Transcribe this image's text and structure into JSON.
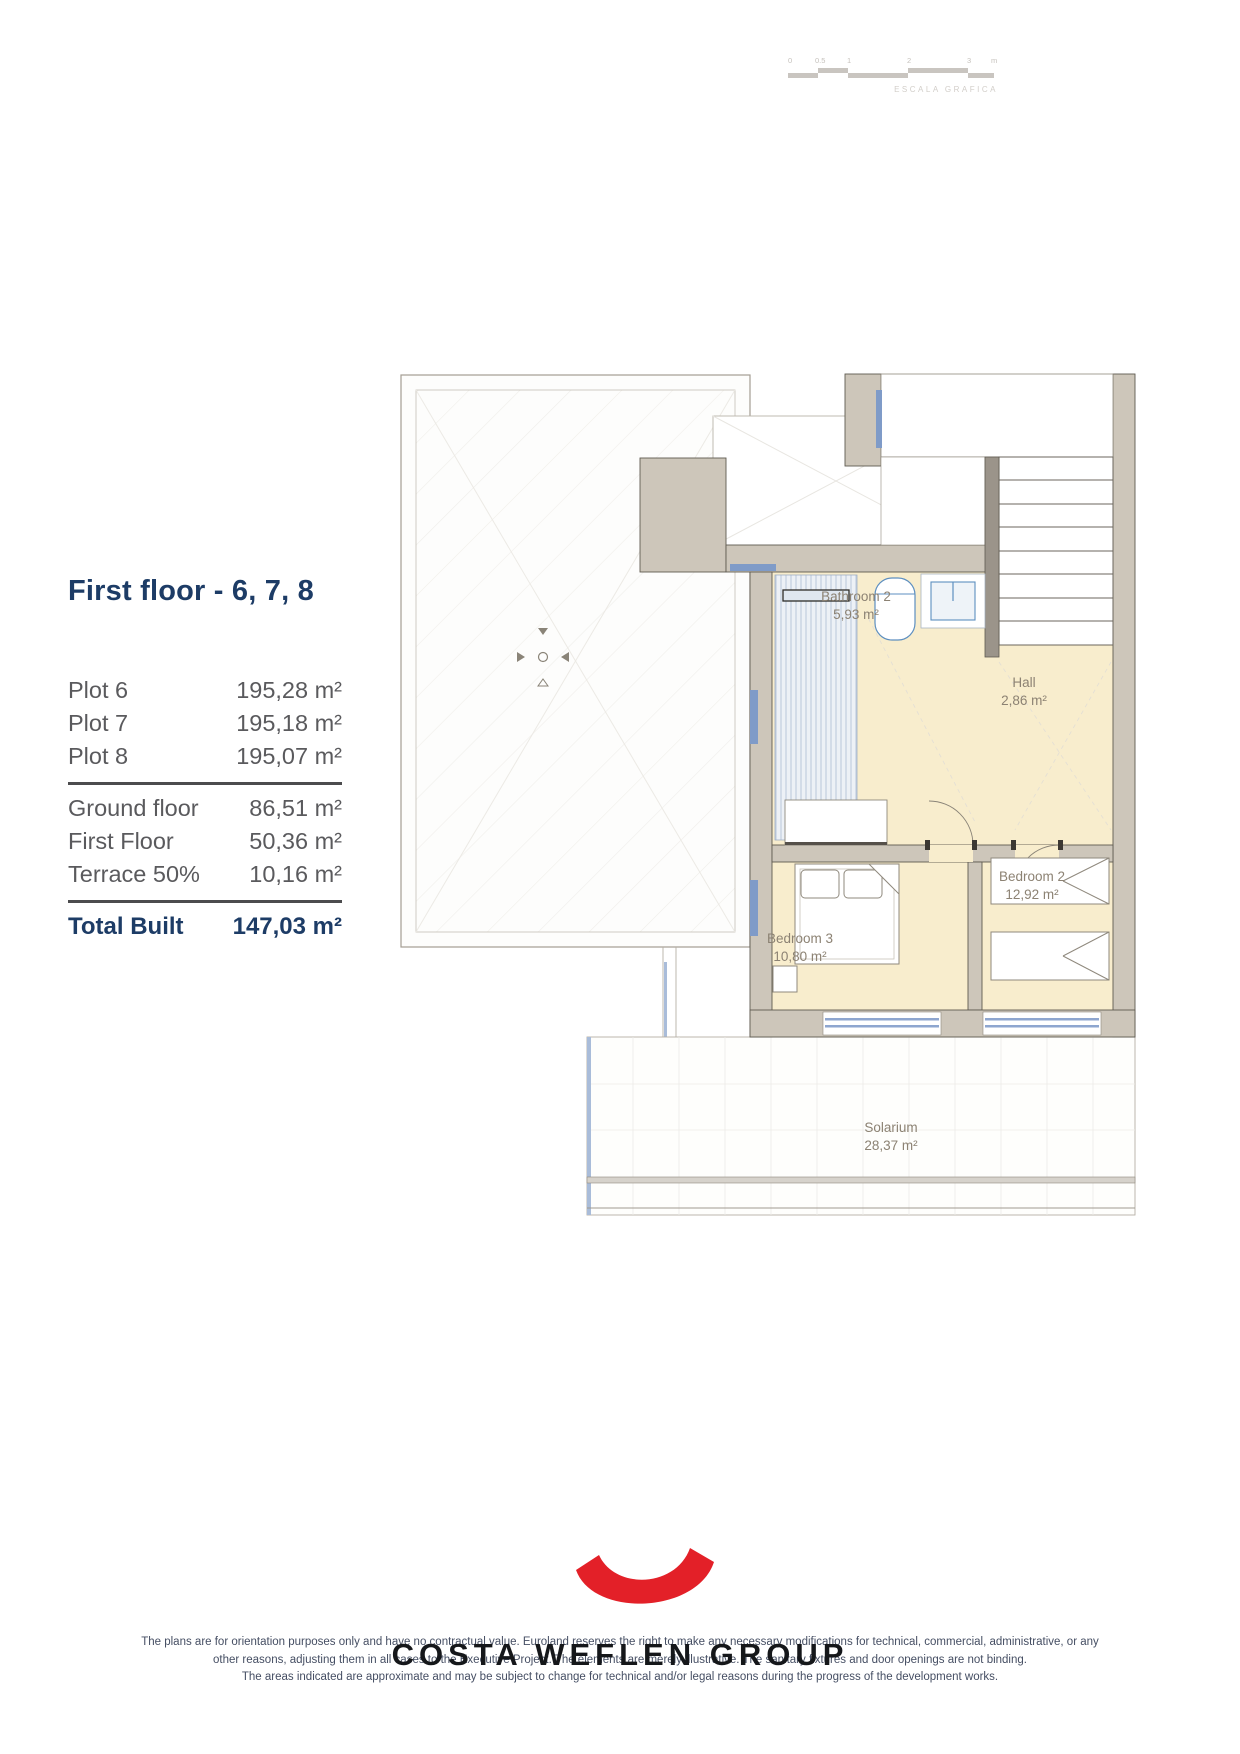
{
  "scale_bar": {
    "caption": "ESCALA GRAFICA",
    "labels": [
      "0",
      "0.5",
      "1",
      "2",
      "3",
      "m"
    ]
  },
  "info_panel": {
    "title": "First floor - 6, 7, 8",
    "plots": [
      {
        "label": "Plot 6",
        "value": "195,28 m²"
      },
      {
        "label": "Plot 7",
        "value": "195,18 m²"
      },
      {
        "label": "Plot 8",
        "value": "195,07 m²"
      }
    ],
    "areas": [
      {
        "label": "Ground floor",
        "value": "86,51 m²"
      },
      {
        "label": "First Floor",
        "value": "50,36 m²"
      },
      {
        "label": "Terrace 50%",
        "value": "10,16 m²"
      }
    ],
    "total": {
      "label": "Total Built",
      "value": "147,03 m²"
    }
  },
  "floor_plan": {
    "rooms": [
      {
        "name": "Bathroom 2",
        "area": "5,93 m²"
      },
      {
        "name": "Hall",
        "area": "2,86 m²"
      },
      {
        "name": "Bedroom 2",
        "area": "12,92 m²"
      },
      {
        "name": "Bedroom 3",
        "area": "10,80 m²"
      },
      {
        "name": "Solarium",
        "area": "28,37 m²"
      }
    ]
  },
  "footer": {
    "brand": "COSTA WEFLEN GROUP",
    "disclaimer": [
      "The plans are for orientation purposes only and have no contractual value. Euroland reserves the right to make any necessary modifications for technical, commercial, administrative, or any",
      "other reasons, adjusting them in all cases to the Executive Project. The elements are merely illustrative. The sanitary fixtures and door openings are not binding.",
      "The areas indicated are approximate and may be subject to change for technical and/or legal reasons during the progress of the development works."
    ]
  },
  "colors": {
    "accent_red": "#e32028",
    "title_navy": "#1d3c66",
    "room_fill": "#f8edcd",
    "wall_gray": "#cdc6ba",
    "window_blue": "#7f9bc8"
  }
}
